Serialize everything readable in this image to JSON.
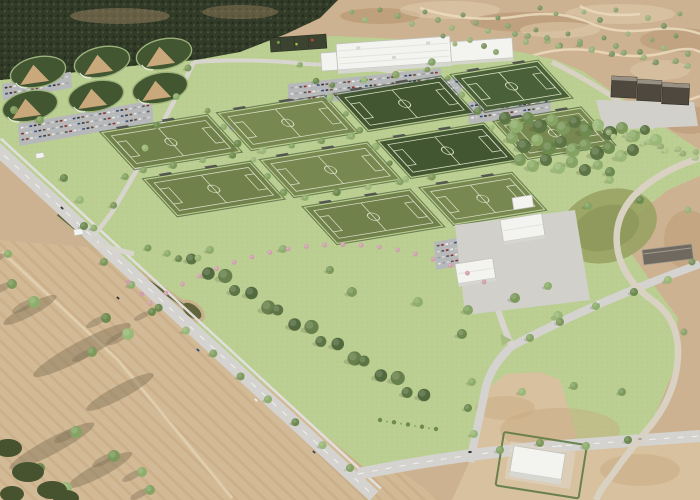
{
  "scene": {
    "title": "Aerial 3D rendering of a sports complex master plan",
    "description": "Bird's-eye architectural rendering: soccer field grid, baseball quadplex, indoor facility, parking lots, lawns, tree rows, roads, canal, and surrounding scrubland and farmland"
  },
  "palette": {
    "scrub": "#cdb292",
    "scrubDark": "#b6946f",
    "scrubLight": "#e0cdae",
    "scrubPath": "#ead9bb",
    "farmland": "#d3ba96",
    "farmLine": "#c3a57e",
    "farmShadow": "#7e7055",
    "farmTrack": "#e3d2b2",
    "lawn": "#bccf93",
    "lawnDot": "#adc184",
    "forest": "#313b28",
    "forestDot1": "#242c1c",
    "forestDot2": "#45523a",
    "forestTan": "#a98c68",
    "fieldOlive": "#71814b",
    "fieldOlive2": "#778850",
    "fieldDark": "#415631",
    "fieldDark2": "#4a6038",
    "fieldLine": "#d7ddc3",
    "hedge": "#35472a",
    "bleacher": "#54574f",
    "infield": "#c9a97b",
    "road": "#d4d3d0",
    "roadMinor": "#d8d5cf",
    "roadDash": "#f4f4f0",
    "sidewalk": "#e0dfdb",
    "windingRoad": "#d9d2c2",
    "parking": "#b6b8b9",
    "canalBank": "#c6b38c",
    "canalWater": "#62653c",
    "basin": "#99a263",
    "basinInner": "#8f9a5c",
    "bldgWhite": "#f3f3f0",
    "bldgFace": "#d7d7d1",
    "bldgStroke": "#c2c2bb",
    "bldgRidge": "#e3e3de",
    "pavilion": "#3c4431",
    "darkBldg": "#4f483e",
    "darkBldgTop": "#979082",
    "plaza": "#d2d0cb",
    "maint": "#6f6960",
    "maintEdge": "#a39d8e",
    "hedgeLine": "#5d7a42",
    "dirt": "#d8c19e",
    "dirtMottle": "#c6a87f",
    "brush": "#47532f",
    "island": "#a9bd82",
    "treeShadow": "#3c4526",
    "pink": "#cf9fae",
    "pinkLight": "#e0bcc7"
  },
  "elements": {
    "soccer": {
      "matrix": [
        0.99,
        -0.162,
        0.68,
        0.745,
        103,
        133
      ],
      "field_w": 105,
      "field_h": 47,
      "col_pitch": 118,
      "row_pitch": 63,
      "fields": [
        {
          "c": 0,
          "r": 0,
          "shade": "olive"
        },
        {
          "c": 1,
          "r": 0,
          "shade": "olive"
        },
        {
          "c": 0,
          "r": 1,
          "shade": "olive"
        },
        {
          "c": 1,
          "r": 1,
          "shade": "olive"
        },
        {
          "c": 2,
          "r": 0,
          "shade": "dark"
        },
        {
          "c": 3,
          "r": 0,
          "shade": "dark",
          "w": 85
        },
        {
          "c": 2,
          "r": 1,
          "shade": "dark"
        },
        {
          "c": 3,
          "r": 1,
          "shade": "olive",
          "w": 85
        },
        {
          "c": 1,
          "r": 2,
          "shade": "olive"
        },
        {
          "c": 2,
          "r": 2,
          "shade": "olive",
          "w": 90
        }
      ],
      "lane_trees": [
        [
          110,
          -6
        ],
        [
          111,
          16
        ],
        [
          110,
          38
        ],
        [
          111,
          60
        ],
        [
          110,
          82
        ],
        [
          111,
          104
        ],
        [
          228,
          -42
        ],
        [
          229,
          -20
        ],
        [
          228,
          2
        ],
        [
          229,
          24
        ],
        [
          228,
          46
        ],
        [
          229,
          68
        ],
        [
          228,
          90
        ],
        [
          229,
          112
        ],
        [
          346,
          -20
        ],
        [
          347,
          2
        ],
        [
          346,
          24
        ],
        [
          347,
          46
        ],
        [
          346,
          68
        ],
        [
          6,
          51
        ],
        [
          36,
          51
        ],
        [
          66,
          51
        ],
        [
          96,
          51
        ],
        [
          126,
          51
        ],
        [
          156,
          51
        ],
        [
          186,
          51
        ],
        [
          216,
          51
        ],
        [
          240,
          -12
        ],
        [
          272,
          -12
        ],
        [
          304,
          -12
        ],
        [
          336,
          -12
        ],
        [
          126,
          114
        ],
        [
          158,
          114
        ],
        [
          190,
          114
        ],
        [
          222,
          114
        ],
        [
          254,
          114
        ]
      ]
    },
    "baseball": {
      "fields": [
        [
          38,
          72
        ],
        [
          102,
          62
        ],
        [
          164,
          54
        ],
        [
          30,
          106
        ],
        [
          96,
          96
        ],
        [
          160,
          88
        ]
      ]
    },
    "parking": {
      "car_colors": [
        "#f2f2f0",
        "#2f3236",
        "#9aa0a5",
        "#8e2f2a",
        "#33507d",
        "#e8e6e1",
        "#55595e",
        "#c8cacc",
        "#6a4f35",
        "#d9d9d6"
      ],
      "lots": [
        {
          "x": 20,
          "y": 126,
          "cols": 30,
          "rows": 3,
          "a": -10
        },
        {
          "x": 4,
          "y": 86,
          "cols": 15,
          "rows": 2,
          "a": -10
        },
        {
          "x": 290,
          "y": 86,
          "cols": 34,
          "rows": 3,
          "a": -6
        },
        {
          "x": 398,
          "y": 86,
          "cols": 14,
          "rows": 3,
          "a": -6
        },
        {
          "x": 470,
          "y": 104,
          "cols": 18,
          "rows": 3,
          "a": -8
        },
        {
          "x": 230,
          "y": 116,
          "cols": 20,
          "rows": 2,
          "a": -10
        },
        {
          "x": 436,
          "y": 244,
          "cols": 12,
          "rows": 4,
          "a": -10
        }
      ]
    },
    "tree_palettes": {
      "std": [
        "#7d9a5c",
        "#8fae6c",
        "#6d8a4f",
        "#9ab877",
        "#85a363"
      ],
      "dark": [
        "#5d7544",
        "#526a3e",
        "#68804b"
      ],
      "pale": [
        "#a3bb80",
        "#96ad74",
        "#aec487"
      ],
      "sage": [
        "#8ca36e",
        "#9db27a",
        "#7e9463"
      ]
    },
    "grove": [
      [
        505,
        118,
        6
      ],
      [
        516,
        126,
        7
      ],
      [
        528,
        118,
        6
      ],
      [
        540,
        126,
        7
      ],
      [
        552,
        120,
        6
      ],
      [
        563,
        128,
        7
      ],
      [
        575,
        122,
        6
      ],
      [
        586,
        130,
        7
      ],
      [
        598,
        125,
        6
      ],
      [
        610,
        133,
        7
      ],
      [
        622,
        128,
        6
      ],
      [
        634,
        136,
        6
      ],
      [
        645,
        130,
        5
      ],
      [
        656,
        140,
        6
      ],
      [
        512,
        138,
        6
      ],
      [
        524,
        146,
        7
      ],
      [
        537,
        140,
        6
      ],
      [
        549,
        148,
        7
      ],
      [
        561,
        142,
        6
      ],
      [
        573,
        150,
        7
      ],
      [
        585,
        145,
        6
      ],
      [
        597,
        153,
        7
      ],
      [
        609,
        148,
        6
      ],
      [
        621,
        156,
        6
      ],
      [
        633,
        150,
        6
      ],
      [
        520,
        160,
        6
      ],
      [
        533,
        166,
        6
      ],
      [
        546,
        160,
        6
      ],
      [
        559,
        168,
        6
      ],
      [
        572,
        162,
        6
      ],
      [
        585,
        170,
        6
      ],
      [
        598,
        165,
        5
      ],
      [
        610,
        172,
        5
      ]
    ],
    "windbreak": {
      "x1": 194,
      "y1": 262,
      "x2": 424,
      "y2": 398,
      "count": 17,
      "r": 5.5
    },
    "road_trees": {
      "x1": 104,
      "y1": 262,
      "x2": 350,
      "y2": 468,
      "count": 10,
      "r": 4
    },
    "tree_rows": [
      {
        "x1": 530,
        "y1": 38,
        "x2": 690,
        "y2": 66,
        "count": 11,
        "r": 3,
        "pal": "sage"
      },
      {
        "x1": 598,
        "y1": 130,
        "x2": 694,
        "y2": 156,
        "count": 12,
        "r": 3,
        "pal": "pale"
      },
      {
        "x1": 190,
        "y1": 70,
        "x2": 96,
        "y2": 230,
        "count": 7,
        "r": 3.5,
        "pal": "std"
      },
      {
        "x1": 150,
        "y1": 250,
        "x2": 196,
        "y2": 260,
        "count": 4,
        "r": 3.5,
        "pal": "std"
      }
    ],
    "singles": [
      [
        352,
        292,
        5
      ],
      [
        418,
        302,
        5
      ],
      [
        462,
        334,
        5
      ],
      [
        558,
        316,
        5
      ],
      [
        588,
        206,
        4
      ],
      [
        330,
        270,
        4
      ],
      [
        283,
        249,
        4
      ],
      [
        64,
        178,
        4
      ],
      [
        80,
        200,
        4
      ],
      [
        468,
        310,
        5
      ],
      [
        515,
        298,
        5
      ],
      [
        548,
        286,
        4
      ],
      [
        84,
        226,
        4
      ],
      [
        610,
        180,
        4
      ],
      [
        40,
        120,
        4
      ],
      [
        14,
        110,
        4
      ],
      [
        472,
        382,
        4
      ],
      [
        468,
        408,
        4
      ],
      [
        474,
        434,
        4
      ],
      [
        530,
        338,
        4
      ],
      [
        560,
        322,
        4
      ],
      [
        596,
        306,
        4
      ],
      [
        634,
        292,
        4
      ],
      [
        668,
        280,
        4
      ],
      [
        500,
        450,
        4
      ],
      [
        540,
        443,
        4
      ],
      [
        586,
        446,
        4
      ],
      [
        628,
        440,
        4
      ],
      [
        522,
        392,
        4
      ],
      [
        574,
        386,
        4
      ],
      [
        622,
        392,
        4
      ],
      [
        210,
        250,
        4
      ],
      [
        640,
        200,
        4
      ]
    ],
    "scrub_trees": [
      [
        352,
        12,
        2.5
      ],
      [
        365,
        20,
        3
      ],
      [
        380,
        10,
        2.5
      ],
      [
        398,
        16,
        3
      ],
      [
        412,
        24,
        3
      ],
      [
        425,
        12,
        2.5
      ],
      [
        438,
        20,
        3
      ],
      [
        452,
        28,
        3
      ],
      [
        463,
        15,
        2.5
      ],
      [
        476,
        23,
        3
      ],
      [
        488,
        31,
        3
      ],
      [
        498,
        18,
        2.5
      ],
      [
        508,
        26,
        3
      ],
      [
        470,
        40,
        3
      ],
      [
        484,
        46,
        3
      ],
      [
        496,
        52,
        3
      ],
      [
        455,
        44,
        2.5
      ],
      [
        443,
        36,
        2.5
      ],
      [
        515,
        34,
        3
      ],
      [
        526,
        42,
        3
      ],
      [
        536,
        30,
        2.5
      ],
      [
        547,
        38,
        3
      ],
      [
        558,
        46,
        3
      ],
      [
        568,
        34,
        2.5
      ],
      [
        580,
        42,
        3
      ],
      [
        592,
        50,
        3
      ],
      [
        604,
        38,
        2.5
      ],
      [
        616,
        46,
        3
      ],
      [
        628,
        34,
        2.5
      ],
      [
        640,
        52,
        3
      ],
      [
        652,
        40,
        2.5
      ],
      [
        664,
        48,
        3
      ],
      [
        676,
        36,
        2.5
      ],
      [
        688,
        54,
        3
      ],
      [
        584,
        12,
        2.5
      ],
      [
        600,
        20,
        3
      ],
      [
        616,
        10,
        2.5
      ],
      [
        648,
        18,
        3
      ],
      [
        664,
        26,
        3
      ],
      [
        680,
        14,
        2.5
      ],
      [
        688,
        210,
        3.5
      ],
      [
        692,
        262,
        3.5
      ],
      [
        684,
        332,
        3.5
      ],
      [
        696,
        152,
        3
      ],
      [
        540,
        8,
        2.5
      ],
      [
        556,
        14,
        2.5
      ]
    ],
    "farm_trees": [
      [
        12,
        284,
        5
      ],
      [
        34,
        302,
        6
      ],
      [
        106,
        318,
        5
      ],
      [
        128,
        334,
        6
      ],
      [
        76,
        432,
        6
      ],
      [
        114,
        456,
        6
      ],
      [
        142,
        472,
        5
      ],
      [
        40,
        468,
        5
      ],
      [
        66,
        488,
        6
      ],
      [
        150,
        490,
        5
      ],
      [
        92,
        352,
        5
      ],
      [
        8,
        254,
        4
      ],
      [
        152,
        312,
        4
      ]
    ],
    "farm_shadows": [
      [
        82,
        350,
        55,
        9
      ],
      [
        52,
        446,
        48,
        8
      ],
      [
        120,
        392,
        38,
        7
      ],
      [
        30,
        310,
        30,
        6
      ],
      [
        100,
        470,
        36,
        7
      ]
    ],
    "brush": [
      [
        8,
        448,
        14,
        9
      ],
      [
        28,
        472,
        16,
        10
      ],
      [
        52,
        490,
        15,
        9
      ],
      [
        12,
        494,
        12,
        8
      ],
      [
        66,
        498,
        13,
        8
      ]
    ],
    "pink_arc": {
      "p": [
        150,
        303,
        250,
        238,
        380,
        222,
        484,
        282
      ],
      "count": 20,
      "extra": [
        [
          128,
          282
        ],
        [
          142,
          294
        ]
      ]
    },
    "shrub_row": {
      "x1": 380,
      "y1": 420,
      "x2": 436,
      "y2": 429,
      "count": 5
    },
    "cars_on_roads": [
      [
        198,
        350,
        "#2f4f88",
        43
      ],
      [
        118,
        298,
        "#3a3a3e",
        43
      ],
      [
        256,
        400,
        "#ececea",
        43
      ],
      [
        314,
        452,
        "#46484c",
        43
      ],
      [
        62,
        208,
        "#3a3a3e",
        43
      ],
      [
        470,
        452,
        "#333538",
        -6
      ],
      [
        560,
        446,
        "#ececea",
        -4
      ],
      [
        640,
        439,
        "#9aa0a5",
        -3
      ],
      [
        598,
        302,
        "#dcdcd9",
        -24
      ]
    ]
  }
}
